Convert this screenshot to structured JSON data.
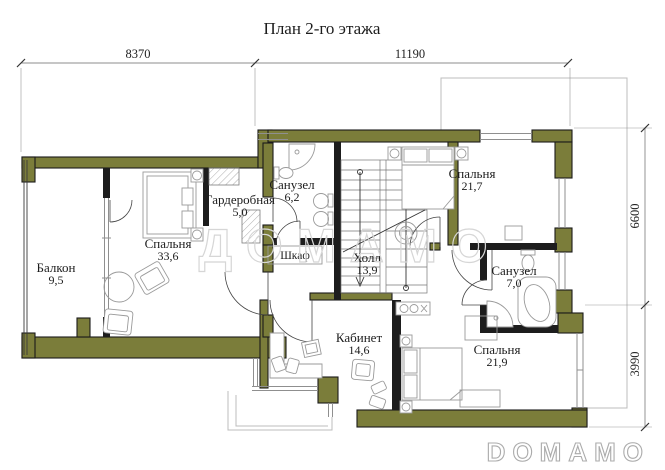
{
  "title": "План 2-го этажа",
  "watermark": "ДОМАМО",
  "logo": "DOMAMO",
  "colors": {
    "wall": "#7b7d3a",
    "partition": "#1d1d1d",
    "furniture_stroke": "#9a9a9a",
    "roof_outline": "#bcbcbc",
    "watermark": "#d6d6d6",
    "logo": "#ababab"
  },
  "dimensions": {
    "top": [
      {
        "value": "8370"
      },
      {
        "value": "11190"
      }
    ],
    "right": [
      {
        "value": "6600"
      },
      {
        "value": "3990"
      }
    ]
  },
  "rooms": [
    {
      "name": "Балкон",
      "area": "9,5",
      "x": 56,
      "y": 272
    },
    {
      "name": "Спальня",
      "area": "33,6",
      "x": 168,
      "y": 248
    },
    {
      "name": "Гардеробная",
      "area": "5,0",
      "x": 240,
      "y": 204
    },
    {
      "name": "Санузел",
      "area": "6,2",
      "x": 292,
      "y": 189
    },
    {
      "name": "Холл",
      "area": "13,9",
      "x": 367,
      "y": 262
    },
    {
      "name": "Спальня",
      "area": "21,7",
      "x": 472,
      "y": 178
    },
    {
      "name": "Санузел",
      "area": "7,0",
      "x": 514,
      "y": 275
    },
    {
      "name": "Кабинет",
      "area": "14,6",
      "x": 359,
      "y": 342
    },
    {
      "name": "Спальня",
      "area": "21,9",
      "x": 497,
      "y": 354
    }
  ],
  "closet_label": "Шкаф"
}
